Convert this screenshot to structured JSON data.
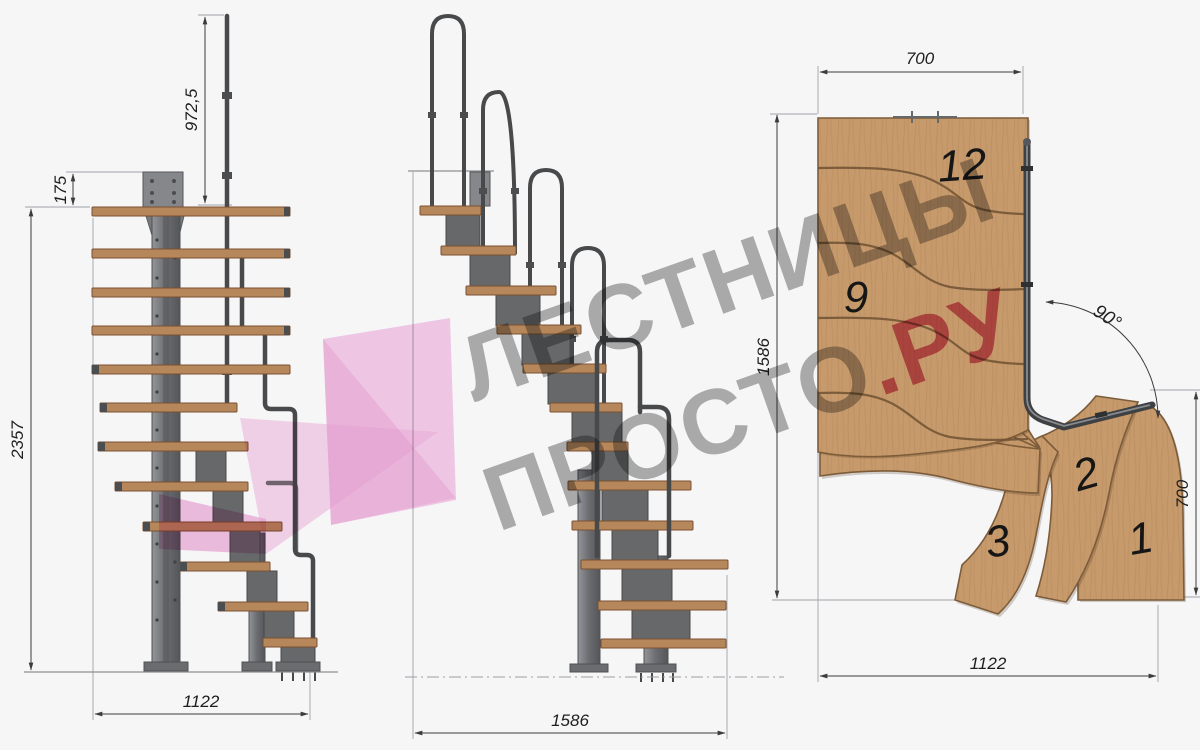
{
  "watermark": {
    "line1": "ЛЕСТНИЦЫ",
    "line2": "ПРОСТО",
    "tld": ".РУ",
    "text_color": "#9c9c9c",
    "tld_color": "#d04b74",
    "arrow_color": "#f0aadc"
  },
  "side_view": {
    "dim_rail_height": "972,5",
    "dim_plate_offset": "175",
    "dim_total_height": "2357",
    "dim_total_run": "1122"
  },
  "front_view": {
    "dim_total_run": "1586"
  },
  "plan_view": {
    "dim_top_width": "700",
    "dim_depth": "1586",
    "dim_right_width": "700",
    "dim_bottom_length": "1122",
    "dim_turn_angle": "90°",
    "step_labels": {
      "s12": "12",
      "s9": "9",
      "s3": "3",
      "s2": "2",
      "s1": "1"
    }
  },
  "colors": {
    "background": "#f6f6f7",
    "wood_plan": "#c79a6c",
    "wood_tread": "#b5875b",
    "steel": "#6e7072",
    "steel_dark": "#47494b",
    "dim_line": "#3c3c3c"
  }
}
